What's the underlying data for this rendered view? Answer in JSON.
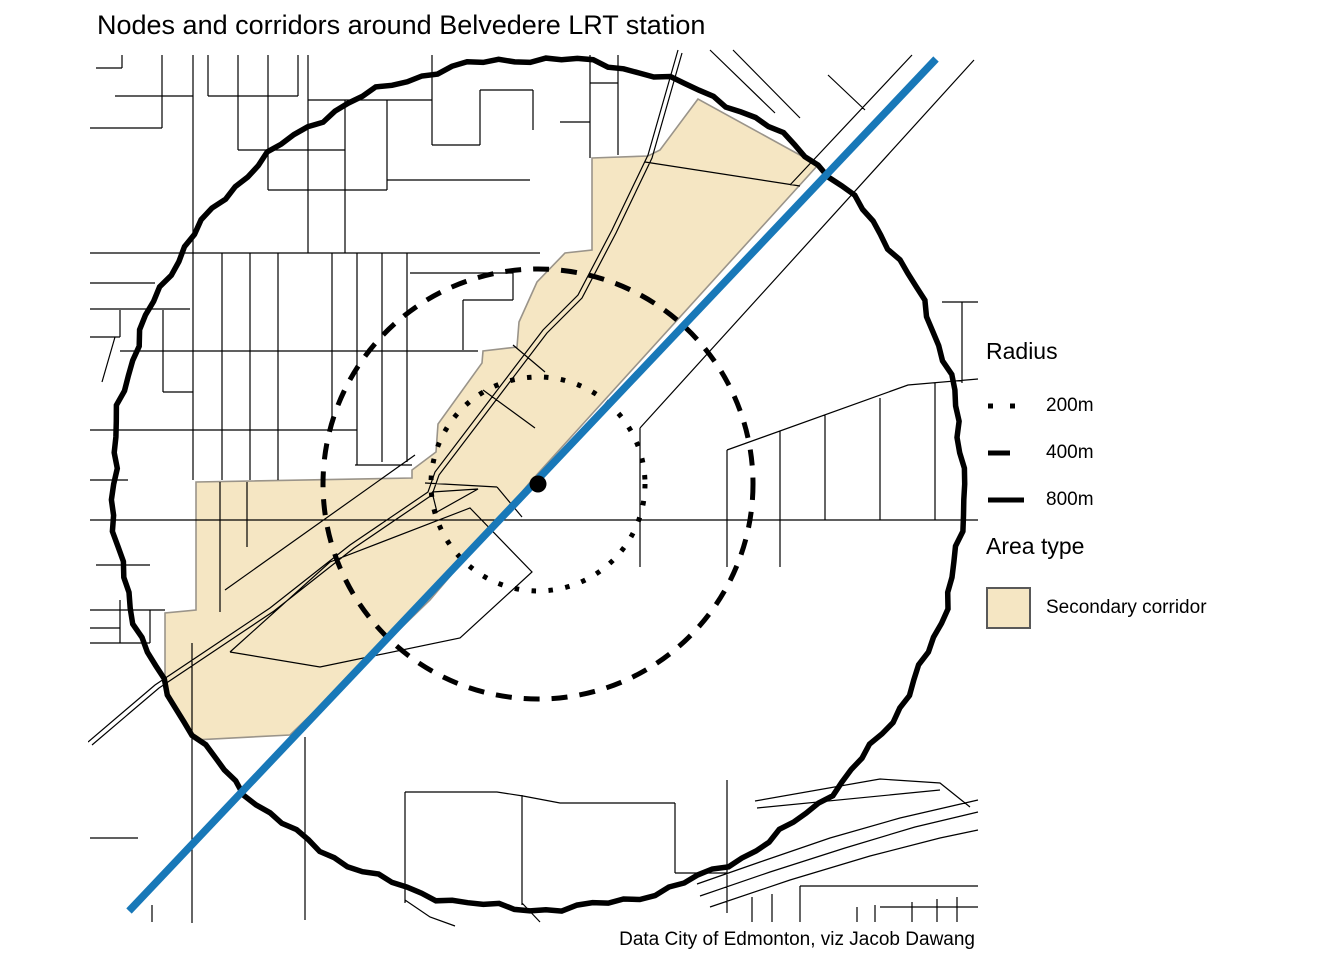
{
  "title": "Nodes and corridors around Belvedere LRT station",
  "caption": "Data City of Edmonton, viz Jacob Dawang",
  "legend": {
    "radius": {
      "title": "Radius",
      "items": [
        {
          "label": "200m",
          "style": "dotted"
        },
        {
          "label": "400m",
          "style": "dashed"
        },
        {
          "label": "800m",
          "style": "solid"
        }
      ]
    },
    "area": {
      "title": "Area type",
      "items": [
        {
          "label": "Secondary corridor",
          "fill": "#F5E6C3",
          "border": "#595959"
        }
      ]
    }
  },
  "colors": {
    "street": "#000000",
    "circle": "#000000",
    "lrt": "#1878B8",
    "station": "#000000",
    "corridor_fill": "#F5E6C3",
    "corridor_border": "#9A948A",
    "background": "#FFFFFF"
  },
  "map": {
    "panel": {
      "x": 88,
      "y": 48,
      "w": 892,
      "h": 880
    },
    "center": {
      "x": 538,
      "y": 484
    },
    "station": {
      "r": 8.5
    },
    "lrt_line": {
      "pts": [
        [
          936,
          59
        ],
        [
          129,
          911
        ]
      ],
      "width": 7.5
    },
    "circles": [
      {
        "label": "200m",
        "r": 107,
        "style": "dotted",
        "width": 5
      },
      {
        "label": "400m",
        "r": 215,
        "style": "dashed",
        "width": 5
      },
      {
        "label": "800m",
        "r": 425,
        "style": "jagged",
        "width": 5.5
      }
    ],
    "corridor": {
      "points": [
        [
          698,
          99
        ],
        [
          660,
          150
        ],
        [
          648,
          156
        ],
        [
          592,
          158
        ],
        [
          592,
          250
        ],
        [
          565,
          253
        ],
        [
          537,
          282
        ],
        [
          519,
          322
        ],
        [
          517,
          347
        ],
        [
          483,
          351
        ],
        [
          482,
          363
        ],
        [
          438,
          424
        ],
        [
          436,
          452
        ],
        [
          412,
          470
        ],
        [
          412,
          478
        ],
        [
          196,
          482
        ],
        [
          196,
          610
        ],
        [
          165,
          613
        ],
        [
          165,
          680
        ],
        [
          145,
          705
        ],
        [
          193,
          740
        ],
        [
          290,
          735
        ],
        [
          430,
          600
        ],
        [
          532,
          480
        ],
        [
          818,
          165
        ]
      ]
    },
    "streets": [
      [
        [
          96,
          68
        ],
        [
          122,
          68
        ]
      ],
      [
        [
          122,
          55
        ],
        [
          122,
          68
        ]
      ],
      [
        [
          162,
          55
        ],
        [
          162,
          128
        ]
      ],
      [
        [
          90,
          128
        ],
        [
          162,
          128
        ]
      ],
      [
        [
          193,
          55
        ],
        [
          193,
          480
        ]
      ],
      [
        [
          208,
          55
        ],
        [
          208,
          96
        ]
      ],
      [
        [
          115,
          96
        ],
        [
          193,
          96
        ]
      ],
      [
        [
          208,
          96
        ],
        [
          298,
          96
        ]
      ],
      [
        [
          238,
          55
        ],
        [
          238,
          150
        ]
      ],
      [
        [
          268,
          55
        ],
        [
          268,
          190
        ]
      ],
      [
        [
          298,
          55
        ],
        [
          298,
          96
        ]
      ],
      [
        [
          308,
          55
        ],
        [
          308,
          253
        ]
      ],
      [
        [
          238,
          150
        ],
        [
          345,
          150
        ]
      ],
      [
        [
          268,
          190
        ],
        [
          387,
          190
        ]
      ],
      [
        [
          345,
          100
        ],
        [
          345,
          253
        ]
      ],
      [
        [
          308,
          100
        ],
        [
          432,
          100
        ]
      ],
      [
        [
          387,
          100
        ],
        [
          387,
          190
        ]
      ],
      [
        [
          387,
          180
        ],
        [
          530,
          180
        ]
      ],
      [
        [
          432,
          55
        ],
        [
          432,
          145
        ]
      ],
      [
        [
          432,
          145
        ],
        [
          480,
          145
        ]
      ],
      [
        [
          480,
          90
        ],
        [
          480,
          145
        ]
      ],
      [
        [
          480,
          90
        ],
        [
          533,
          90
        ]
      ],
      [
        [
          533,
          90
        ],
        [
          533,
          130
        ]
      ],
      [
        [
          590,
          55
        ],
        [
          590,
          158
        ]
      ],
      [
        [
          590,
          83
        ],
        [
          618,
          83
        ]
      ],
      [
        [
          618,
          55
        ],
        [
          618,
          155
        ]
      ],
      [
        [
          560,
          122
        ],
        [
          590,
          122
        ]
      ],
      [
        [
          90,
          253
        ],
        [
          540,
          253
        ]
      ],
      [
        [
          222,
          253
        ],
        [
          222,
          480
        ]
      ],
      [
        [
          250,
          253
        ],
        [
          250,
          480
        ]
      ],
      [
        [
          278,
          253
        ],
        [
          278,
          480
        ]
      ],
      [
        [
          332,
          253
        ],
        [
          332,
          430
        ]
      ],
      [
        [
          357,
          253
        ],
        [
          357,
          465
        ]
      ],
      [
        [
          382,
          253
        ],
        [
          382,
          462
        ]
      ],
      [
        [
          407,
          253
        ],
        [
          407,
          462
        ]
      ],
      [
        [
          120,
          351
        ],
        [
          478,
          351
        ]
      ],
      [
        [
          192,
          430
        ],
        [
          357,
          430
        ]
      ],
      [
        [
          355,
          465
        ],
        [
          412,
          465
        ]
      ],
      [
        [
          90,
          283
        ],
        [
          155,
          283
        ]
      ],
      [
        [
          90,
          309
        ],
        [
          190,
          309
        ]
      ],
      [
        [
          120,
          310
        ],
        [
          120,
          337
        ]
      ],
      [
        [
          90,
          337
        ],
        [
          120,
          337
        ]
      ],
      [
        [
          115,
          337
        ],
        [
          102,
          382
        ]
      ],
      [
        [
          163,
          310
        ],
        [
          163,
          392
        ]
      ],
      [
        [
          163,
          392
        ],
        [
          193,
          392
        ]
      ],
      [
        [
          410,
          273
        ],
        [
          513,
          273
        ]
      ],
      [
        [
          513,
          273
        ],
        [
          513,
          300
        ]
      ],
      [
        [
          463,
          300
        ],
        [
          513,
          300
        ]
      ],
      [
        [
          463,
          300
        ],
        [
          463,
          350
        ]
      ],
      [
        [
          90,
          430
        ],
        [
          196,
          430
        ]
      ],
      [
        [
          90,
          480
        ],
        [
          128,
          480
        ]
      ],
      [
        [
          96,
          565
        ],
        [
          150,
          565
        ]
      ],
      [
        [
          90,
          610
        ],
        [
          165,
          610
        ]
      ],
      [
        [
          90,
          628
        ],
        [
          120,
          628
        ]
      ],
      [
        [
          90,
          643
        ],
        [
          150,
          643
        ]
      ],
      [
        [
          120,
          600
        ],
        [
          120,
          643
        ]
      ],
      [
        [
          150,
          610
        ],
        [
          150,
          643
        ]
      ],
      [
        [
          90,
          520
        ],
        [
          978,
          520
        ]
      ],
      [
        [
          912,
          55
        ],
        [
          790,
          185
        ]
      ],
      [
        [
          974,
          60
        ],
        [
          640,
          428
        ]
      ],
      [
        [
          640,
          428
        ],
        [
          640,
          567
        ]
      ],
      [
        [
          710,
          50
        ],
        [
          775,
          113
        ]
      ],
      [
        [
          733,
          50
        ],
        [
          800,
          118
        ]
      ],
      [
        [
          828,
          75
        ],
        [
          865,
          110
        ]
      ],
      [
        [
          727,
          450
        ],
        [
          908,
          385
        ],
        [
          978,
          379
        ]
      ],
      [
        [
          727,
          450
        ],
        [
          727,
          567
        ]
      ],
      [
        [
          780,
          431
        ],
        [
          780,
          567
        ]
      ],
      [
        [
          825,
          415
        ],
        [
          825,
          520
        ]
      ],
      [
        [
          880,
          398
        ],
        [
          880,
          520
        ]
      ],
      [
        [
          935,
          383
        ],
        [
          935,
          520
        ]
      ],
      [
        [
          942,
          302
        ],
        [
          978,
          302
        ]
      ],
      [
        [
          962,
          302
        ],
        [
          962,
          383
        ]
      ],
      [
        [
          405,
          792
        ],
        [
          497,
          792
        ],
        [
          523,
          796
        ],
        [
          560,
          803
        ],
        [
          675,
          803
        ]
      ],
      [
        [
          405,
          792
        ],
        [
          405,
          903
        ]
      ],
      [
        [
          522,
          795
        ],
        [
          522,
          905
        ]
      ],
      [
        [
          675,
          803
        ],
        [
          675,
          873
        ]
      ],
      [
        [
          675,
          873
        ],
        [
          727,
          873
        ]
      ],
      [
        [
          727,
          780
        ],
        [
          727,
          913
        ]
      ],
      [
        [
          697,
          884
        ],
        [
          760,
          862
        ],
        [
          830,
          838
        ],
        [
          900,
          818
        ],
        [
          978,
          800
        ]
      ],
      [
        [
          700,
          896
        ],
        [
          770,
          872
        ],
        [
          845,
          848
        ],
        [
          915,
          827
        ],
        [
          978,
          812
        ]
      ],
      [
        [
          710,
          907
        ],
        [
          790,
          880
        ],
        [
          870,
          856
        ],
        [
          940,
          838
        ],
        [
          978,
          830
        ]
      ],
      [
        [
          755,
          801
        ],
        [
          880,
          779
        ],
        [
          940,
          783
        ],
        [
          970,
          807
        ]
      ],
      [
        [
          757,
          808
        ],
        [
          940,
          790
        ]
      ],
      [
        [
          800,
          886
        ],
        [
          978,
          886
        ]
      ],
      [
        [
          752,
          897
        ],
        [
          752,
          922
        ]
      ],
      [
        [
          772,
          894
        ],
        [
          772,
          922
        ]
      ],
      [
        [
          800,
          886
        ],
        [
          800,
          922
        ]
      ],
      [
        [
          857,
          907
        ],
        [
          857,
          922
        ]
      ],
      [
        [
          875,
          905
        ],
        [
          875,
          922
        ]
      ],
      [
        [
          912,
          902
        ],
        [
          912,
          922
        ]
      ],
      [
        [
          937,
          899
        ],
        [
          937,
          922
        ]
      ],
      [
        [
          957,
          897
        ],
        [
          957,
          922
        ]
      ],
      [
        [
          880,
          907
        ],
        [
          978,
          907
        ]
      ],
      [
        [
          405,
          900
        ],
        [
          430,
          917
        ],
        [
          455,
          926
        ]
      ],
      [
        [
          522,
          903
        ],
        [
          540,
          922
        ]
      ],
      [
        [
          192,
          643
        ],
        [
          192,
          923
        ]
      ],
      [
        [
          305,
          737
        ],
        [
          305,
          920
        ]
      ],
      [
        [
          152,
          905
        ],
        [
          152,
          922
        ]
      ],
      [
        [
          90,
          838
        ],
        [
          138,
          838
        ]
      ],
      [
        [
          678,
          50
        ],
        [
          648,
          155
        ],
        [
          612,
          230
        ],
        [
          578,
          295
        ],
        [
          543,
          330
        ],
        [
          435,
          472
        ],
        [
          428,
          492
        ],
        [
          350,
          545
        ],
        [
          270,
          608
        ],
        [
          155,
          685
        ],
        [
          88,
          742
        ]
      ],
      [
        [
          682,
          53
        ],
        [
          652,
          158
        ],
        [
          616,
          233
        ],
        [
          582,
          298
        ],
        [
          547,
          333
        ],
        [
          439,
          475
        ],
        [
          432,
          495
        ],
        [
          354,
          548
        ],
        [
          274,
          611
        ],
        [
          159,
          688
        ],
        [
          92,
          745
        ]
      ],
      [
        [
          645,
          162
        ],
        [
          800,
          186
        ]
      ],
      [
        [
          483,
          390
        ],
        [
          535,
          428
        ]
      ],
      [
        [
          513,
          345
        ],
        [
          545,
          372
        ]
      ],
      [
        [
          220,
          482
        ],
        [
          220,
          612
        ]
      ],
      [
        [
          247,
          482
        ],
        [
          247,
          547
        ]
      ],
      [
        [
          225,
          590
        ],
        [
          415,
          455
        ]
      ],
      [
        [
          230,
          652
        ],
        [
          320,
          667
        ],
        [
          460,
          638
        ],
        [
          532,
          572
        ],
        [
          470,
          508
        ],
        [
          330,
          562
        ],
        [
          230,
          652
        ]
      ],
      [
        [
          432,
          492
        ],
        [
          478,
          489
        ],
        [
          437,
          512
        ],
        [
          432,
          492
        ]
      ],
      [
        [
          425,
          483
        ],
        [
          497,
          487
        ]
      ],
      [
        [
          497,
          487
        ],
        [
          522,
          517
        ]
      ]
    ]
  },
  "chart_data": {
    "type": "map",
    "title": "Nodes and corridors around Belvedere LRT station",
    "caption": "Data City of Edmonton, viz Jacob Dawang",
    "station": "Belvedere LRT station",
    "radii_m": [
      200,
      400,
      800
    ],
    "area_types": [
      "Secondary corridor"
    ],
    "legend_position": "right"
  }
}
